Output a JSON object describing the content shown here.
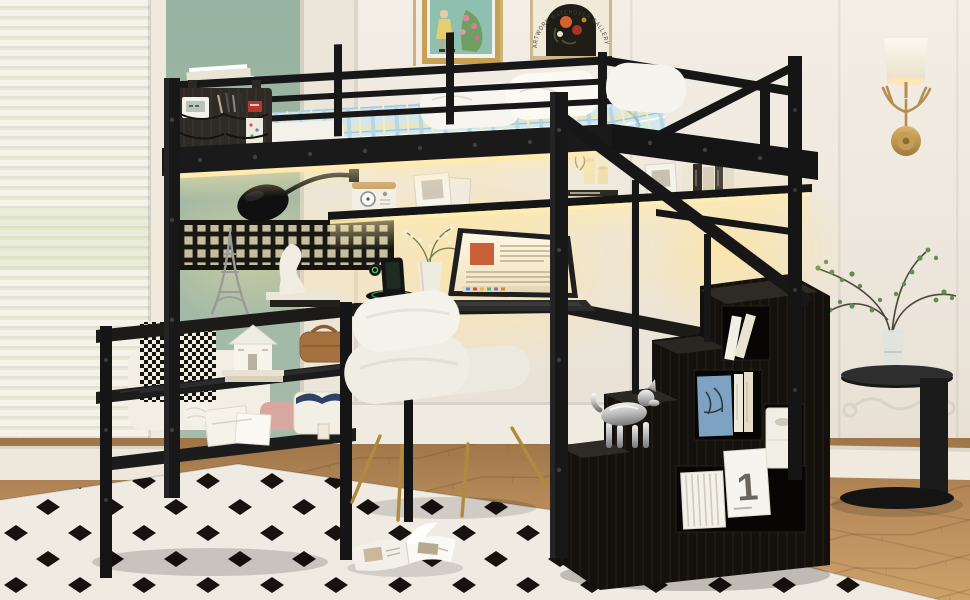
{
  "scene": {
    "type": "product-photo",
    "subject": "Black metal loft bed with under-bed desk, LED lighting, storage shelves and a storage staircase, styled in a bright bedroom",
    "poster": {
      "arc_text": "ARTWORK WATCHOVER GALLERY"
    },
    "storage_box_label": "1",
    "palette": {
      "wall_cream": "#efe9e0",
      "accent_green": "#9cb7a4",
      "frame_black": "#161616",
      "bedding_plaid": "#cfe4ee",
      "warm_led": "#ffe3a0",
      "floor_wood": "#c09468",
      "rug_cream": "#efeae2",
      "rug_diamond": "#17130f",
      "chair_white": "#f0ede6",
      "brass_gold": "#b9924d",
      "chrome_silver": "#c9c9c9"
    },
    "elements": [
      "venetian-blinds",
      "sage-accent-wall",
      "gold-framed-painting",
      "arch-poster",
      "antler-wall-sconce",
      "loft-bed-frame",
      "guardrail",
      "bedside-caddy",
      "plaid-bedding",
      "pillows",
      "led-strip",
      "floating-shelf",
      "retro-radio",
      "picture-frames",
      "desk-lamp",
      "mesh-panel",
      "laptop",
      "charging-stand",
      "flower-vase",
      "storage-shelves",
      "eiffel-tower-model",
      "house-model",
      "leather-case",
      "gift-boxes",
      "yarn-ball",
      "basket",
      "upholstered-chair",
      "storage-staircase",
      "stair-handrail",
      "dog-sculpture",
      "book-cubby",
      "numbered-storage-box",
      "striped-box",
      "fabric-bin",
      "round-side-table",
      "branch-vase",
      "diamond-pattern-rug",
      "open-magazine",
      "bench-blanket"
    ]
  }
}
